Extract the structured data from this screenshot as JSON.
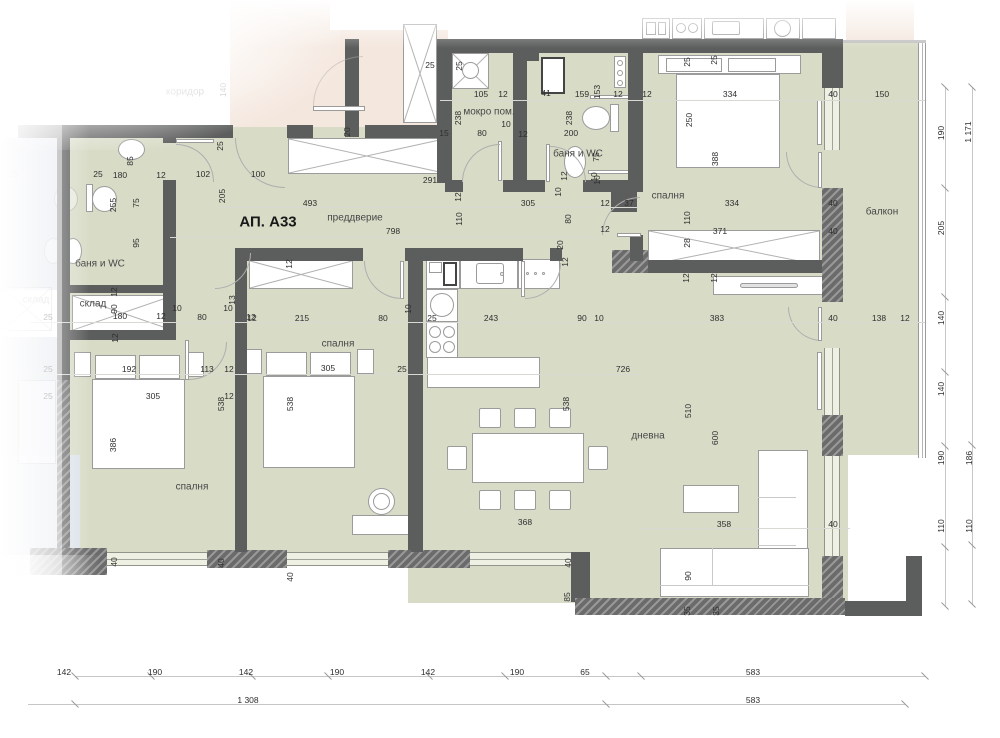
{
  "title": "АП. А33",
  "colors": {
    "floor": "#d8dcc7",
    "wall": "#5c5d5d",
    "neighbor_pink": "#f4e7de",
    "neighbor_blue": "#d5dbe4"
  },
  "rooms": [
    {
      "label": "АП. А33",
      "x": 268,
      "y": 222,
      "s": "t"
    },
    {
      "label": "преддверие",
      "x": 355,
      "y": 218,
      "s": "n"
    },
    {
      "label": "мокро пом.",
      "x": 489,
      "y": 112,
      "s": "n"
    },
    {
      "label": "баня и WC",
      "x": 578,
      "y": 154,
      "s": "n"
    },
    {
      "label": "баня и WC",
      "x": 100,
      "y": 264,
      "s": "n"
    },
    {
      "label": "склад",
      "x": 93,
      "y": 304,
      "s": "n"
    },
    {
      "label": "склад",
      "x": 36,
      "y": 300,
      "s": "f"
    },
    {
      "label": "коридор",
      "x": 185,
      "y": 92,
      "s": "f"
    },
    {
      "label": "спалня",
      "x": 668,
      "y": 196,
      "s": "n"
    },
    {
      "label": "спалня",
      "x": 192,
      "y": 487,
      "s": "n"
    },
    {
      "label": "спалня",
      "x": 338,
      "y": 344,
      "s": "n"
    },
    {
      "label": "дневна",
      "x": 648,
      "y": 436,
      "s": "n"
    },
    {
      "label": "балкон",
      "x": 882,
      "y": 212,
      "s": "n"
    }
  ],
  "dims": [
    {
      "t": "25",
      "x": 98,
      "y": 174
    },
    {
      "t": "180",
      "x": 120,
      "y": 175
    },
    {
      "t": "12",
      "x": 161,
      "y": 175
    },
    {
      "t": "102",
      "x": 203,
      "y": 174
    },
    {
      "t": "100",
      "x": 258,
      "y": 174
    },
    {
      "t": "493",
      "x": 310,
      "y": 203
    },
    {
      "t": "798",
      "x": 393,
      "y": 231
    },
    {
      "t": "291",
      "x": 430,
      "y": 180
    },
    {
      "t": "25",
      "x": 430,
      "y": 65
    },
    {
      "t": "105",
      "x": 481,
      "y": 94
    },
    {
      "t": "12",
      "x": 503,
      "y": 94
    },
    {
      "t": "41",
      "x": 546,
      "y": 93
    },
    {
      "t": "159",
      "x": 582,
      "y": 94
    },
    {
      "t": "12",
      "x": 618,
      "y": 94
    },
    {
      "t": "12",
      "x": 647,
      "y": 94
    },
    {
      "t": "10",
      "x": 506,
      "y": 124
    },
    {
      "t": "12",
      "x": 523,
      "y": 134
    },
    {
      "t": "80",
      "x": 482,
      "y": 133
    },
    {
      "t": "200",
      "x": 571,
      "y": 133
    },
    {
      "t": "15",
      "x": 444,
      "y": 133
    },
    {
      "t": "305",
      "x": 528,
      "y": 203
    },
    {
      "t": "12",
      "x": 605,
      "y": 203
    },
    {
      "t": "37",
      "x": 629,
      "y": 203
    },
    {
      "t": "12",
      "x": 605,
      "y": 229
    },
    {
      "t": "334",
      "x": 730,
      "y": 94
    },
    {
      "t": "40",
      "x": 833,
      "y": 94
    },
    {
      "t": "150",
      "x": 882,
      "y": 94
    },
    {
      "t": "334",
      "x": 732,
      "y": 203
    },
    {
      "t": "371",
      "x": 720,
      "y": 231
    },
    {
      "t": "40",
      "x": 833,
      "y": 203
    },
    {
      "t": "40",
      "x": 833,
      "y": 231
    },
    {
      "t": "40",
      "x": 833,
      "y": 318
    },
    {
      "t": "138",
      "x": 879,
      "y": 318
    },
    {
      "t": "12",
      "x": 905,
      "y": 318
    },
    {
      "t": "25",
      "x": 48,
      "y": 317
    },
    {
      "t": "180",
      "x": 120,
      "y": 316
    },
    {
      "t": "12",
      "x": 161,
      "y": 316
    },
    {
      "t": "10",
      "x": 177,
      "y": 308
    },
    {
      "t": "80",
      "x": 202,
      "y": 317
    },
    {
      "t": "10",
      "x": 228,
      "y": 308
    },
    {
      "t": "12",
      "x": 251,
      "y": 317
    },
    {
      "t": "192",
      "x": 129,
      "y": 369
    },
    {
      "t": "113",
      "x": 207,
      "y": 369
    },
    {
      "t": "12",
      "x": 229,
      "y": 369
    },
    {
      "t": "25",
      "x": 48,
      "y": 369
    },
    {
      "t": "25",
      "x": 48,
      "y": 396
    },
    {
      "t": "305",
      "x": 153,
      "y": 396
    },
    {
      "t": "12",
      "x": 229,
      "y": 396
    },
    {
      "t": "12",
      "x": 252,
      "y": 318
    },
    {
      "t": "215",
      "x": 302,
      "y": 318
    },
    {
      "t": "80",
      "x": 383,
      "y": 318
    },
    {
      "t": "25",
      "x": 432,
      "y": 318
    },
    {
      "t": "243",
      "x": 491,
      "y": 318
    },
    {
      "t": "305",
      "x": 328,
      "y": 368
    },
    {
      "t": "25",
      "x": 402,
      "y": 369
    },
    {
      "t": "90",
      "x": 582,
      "y": 318
    },
    {
      "t": "10",
      "x": 599,
      "y": 318
    },
    {
      "t": "383",
      "x": 717,
      "y": 318
    },
    {
      "t": "726",
      "x": 623,
      "y": 369
    },
    {
      "t": "368",
      "x": 525,
      "y": 522
    },
    {
      "t": "358",
      "x": 724,
      "y": 524
    },
    {
      "t": "40",
      "x": 833,
      "y": 524
    },
    {
      "t": "142",
      "x": 64,
      "y": 672
    },
    {
      "t": "190",
      "x": 155,
      "y": 672
    },
    {
      "t": "142",
      "x": 246,
      "y": 672
    },
    {
      "t": "190",
      "x": 337,
      "y": 672
    },
    {
      "t": "142",
      "x": 428,
      "y": 672
    },
    {
      "t": "190",
      "x": 517,
      "y": 672
    },
    {
      "t": "65",
      "x": 585,
      "y": 672
    },
    {
      "t": "583",
      "x": 753,
      "y": 672
    },
    {
      "t": "1 308",
      "x": 248,
      "y": 700
    },
    {
      "t": "583",
      "x": 753,
      "y": 700
    },
    {
      "t": "140",
      "x": 223,
      "y": 90,
      "r": 1,
      "f": 1
    },
    {
      "t": "85",
      "x": 130,
      "y": 161,
      "r": 1
    },
    {
      "t": "255",
      "x": 113,
      "y": 205,
      "r": 1
    },
    {
      "t": "75",
      "x": 136,
      "y": 203,
      "r": 1
    },
    {
      "t": "95",
      "x": 136,
      "y": 243,
      "r": 1
    },
    {
      "t": "205",
      "x": 222,
      "y": 196,
      "r": 1
    },
    {
      "t": "25",
      "x": 220,
      "y": 146,
      "r": 1
    },
    {
      "t": "25",
      "x": 459,
      "y": 66,
      "r": 1
    },
    {
      "t": "238",
      "x": 458,
      "y": 118,
      "r": 1
    },
    {
      "t": "238",
      "x": 569,
      "y": 118,
      "r": 1
    },
    {
      "t": "153",
      "x": 597,
      "y": 92,
      "r": 1
    },
    {
      "t": "75",
      "x": 596,
      "y": 157,
      "r": 1
    },
    {
      "t": "10",
      "x": 597,
      "y": 180,
      "r": 1
    },
    {
      "t": "20",
      "x": 347,
      "y": 132,
      "r": 1
    },
    {
      "t": "12",
      "x": 458,
      "y": 197,
      "r": 1
    },
    {
      "t": "110",
      "x": 459,
      "y": 219,
      "r": 1
    },
    {
      "t": "80",
      "x": 568,
      "y": 219,
      "r": 1
    },
    {
      "t": "10",
      "x": 558,
      "y": 192,
      "r": 1
    },
    {
      "t": "12",
      "x": 564,
      "y": 176,
      "r": 1
    },
    {
      "t": "10",
      "x": 594,
      "y": 177,
      "r": 1
    },
    {
      "t": "20",
      "x": 560,
      "y": 245,
      "r": 1
    },
    {
      "t": "12",
      "x": 565,
      "y": 262,
      "r": 1
    },
    {
      "t": "25",
      "x": 687,
      "y": 62,
      "r": 1
    },
    {
      "t": "25",
      "x": 714,
      "y": 60,
      "r": 1
    },
    {
      "t": "250",
      "x": 689,
      "y": 120,
      "r": 1
    },
    {
      "t": "388",
      "x": 715,
      "y": 159,
      "r": 1
    },
    {
      "t": "110",
      "x": 687,
      "y": 218,
      "r": 1
    },
    {
      "t": "28",
      "x": 687,
      "y": 243,
      "r": 1
    },
    {
      "t": "12",
      "x": 686,
      "y": 278,
      "r": 1
    },
    {
      "t": "12",
      "x": 714,
      "y": 278,
      "r": 1
    },
    {
      "t": "90",
      "x": 114,
      "y": 309,
      "r": 1
    },
    {
      "t": "12",
      "x": 114,
      "y": 292,
      "r": 1
    },
    {
      "t": "13",
      "x": 232,
      "y": 300,
      "r": 1
    },
    {
      "t": "12",
      "x": 115,
      "y": 338,
      "r": 1
    },
    {
      "t": "538",
      "x": 221,
      "y": 404,
      "r": 1
    },
    {
      "t": "386",
      "x": 113,
      "y": 445,
      "r": 1
    },
    {
      "t": "538",
      "x": 290,
      "y": 404,
      "r": 1
    },
    {
      "t": "12",
      "x": 289,
      "y": 264,
      "r": 1
    },
    {
      "t": "10",
      "x": 408,
      "y": 309,
      "r": 1
    },
    {
      "t": "538",
      "x": 566,
      "y": 404,
      "r": 1
    },
    {
      "t": "510",
      "x": 688,
      "y": 411,
      "r": 1
    },
    {
      "t": "600",
      "x": 715,
      "y": 438,
      "r": 1
    },
    {
      "t": "90",
      "x": 688,
      "y": 576,
      "r": 1
    },
    {
      "t": "40",
      "x": 114,
      "y": 562,
      "r": 1
    },
    {
      "t": "40",
      "x": 221,
      "y": 563,
      "r": 1
    },
    {
      "t": "40",
      "x": 290,
      "y": 577,
      "r": 1
    },
    {
      "t": "40",
      "x": 568,
      "y": 563,
      "r": 1
    },
    {
      "t": "85",
      "x": 567,
      "y": 597,
      "r": 1
    },
    {
      "t": "35",
      "x": 687,
      "y": 611,
      "r": 1
    },
    {
      "t": "35",
      "x": 716,
      "y": 611,
      "r": 1
    },
    {
      "t": "190",
      "x": 941,
      "y": 133,
      "r": 1
    },
    {
      "t": "205",
      "x": 941,
      "y": 228,
      "r": 1
    },
    {
      "t": "140",
      "x": 941,
      "y": 318,
      "r": 1
    },
    {
      "t": "140",
      "x": 941,
      "y": 389,
      "r": 1
    },
    {
      "t": "190",
      "x": 941,
      "y": 458,
      "r": 1
    },
    {
      "t": "110",
      "x": 941,
      "y": 526,
      "r": 1
    },
    {
      "t": "1 171",
      "x": 968,
      "y": 132,
      "r": 1
    },
    {
      "t": "186",
      "x": 969,
      "y": 458,
      "r": 1
    },
    {
      "t": "110",
      "x": 969,
      "y": 526,
      "r": 1
    },
    {
      "t": "25",
      "x": 14,
      "y": 174,
      "f": 1
    }
  ],
  "dim_rows": [
    {
      "axis": "h",
      "y": 676,
      "x1": 75,
      "x2": 925,
      "ticks": [
        75,
        151,
        252,
        328,
        429,
        505,
        606,
        641,
        925
      ]
    },
    {
      "axis": "h",
      "y": 704,
      "x1": 28,
      "x2": 905,
      "ticks": [
        75,
        606,
        905
      ]
    },
    {
      "axis": "v",
      "x": 945,
      "y1": 87,
      "y2": 606,
      "ticks": [
        87,
        188,
        297,
        372,
        446,
        547,
        606
      ]
    },
    {
      "axis": "v",
      "x": 972,
      "y1": 87,
      "y2": 604,
      "ticks": [
        87,
        445,
        545,
        604
      ]
    }
  ]
}
